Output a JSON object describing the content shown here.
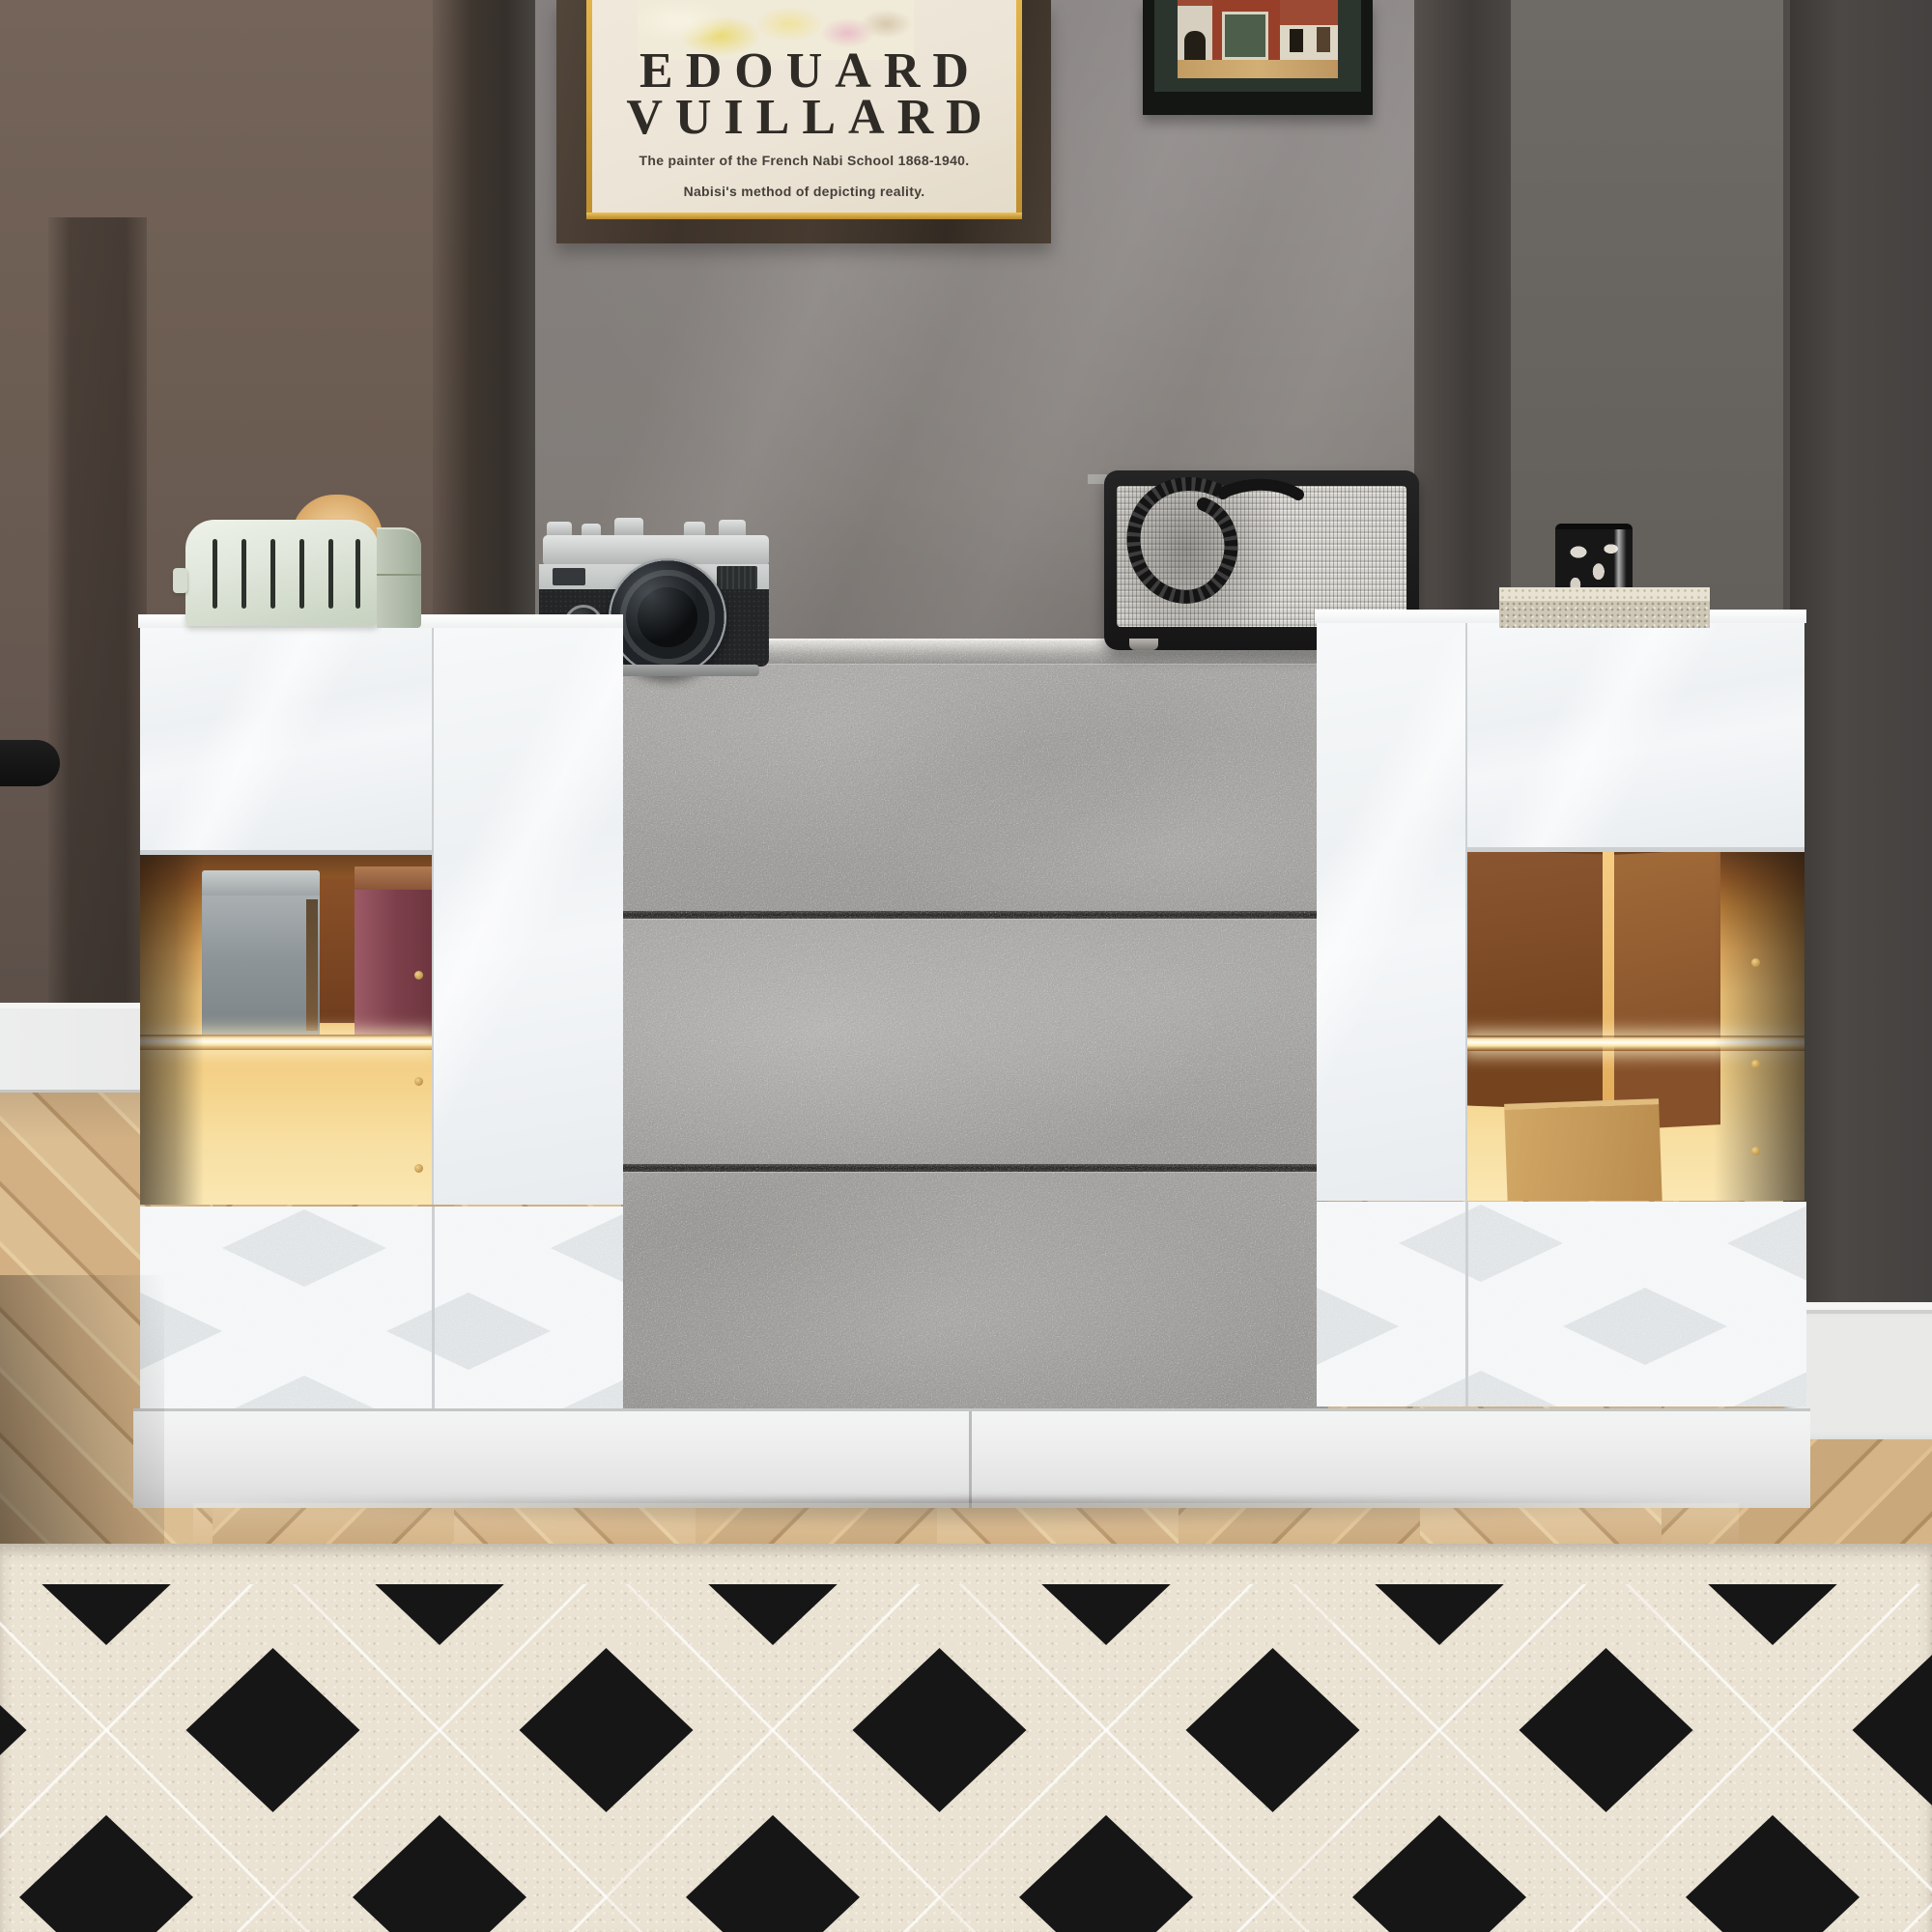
{
  "poster": {
    "title_line1": "EDOUARD",
    "title_line2": "VUILLARD",
    "subtitle_line1": "The painter of the French Nabi School 1868-1940.",
    "subtitle_line2": "Nabisi's method of depicting reality."
  },
  "camera": {
    "brand": "Nikon"
  },
  "colors": {
    "wall_center_gray": "#827d79",
    "wall_left_brown": "#6f6055",
    "wall_pillar_dark": "#454240",
    "cabinet_gloss_white": "#f4f6f8",
    "concrete_drawer": "#9e9d9b",
    "led_glow_amber": "#f3cd84",
    "poster_paper": "#ece4d6",
    "frame_gold": "#d9a73f",
    "rug_base_cream": "#eae2d2",
    "rug_diamond_black": "#161616",
    "floor_oak": "#d8ba8f"
  }
}
